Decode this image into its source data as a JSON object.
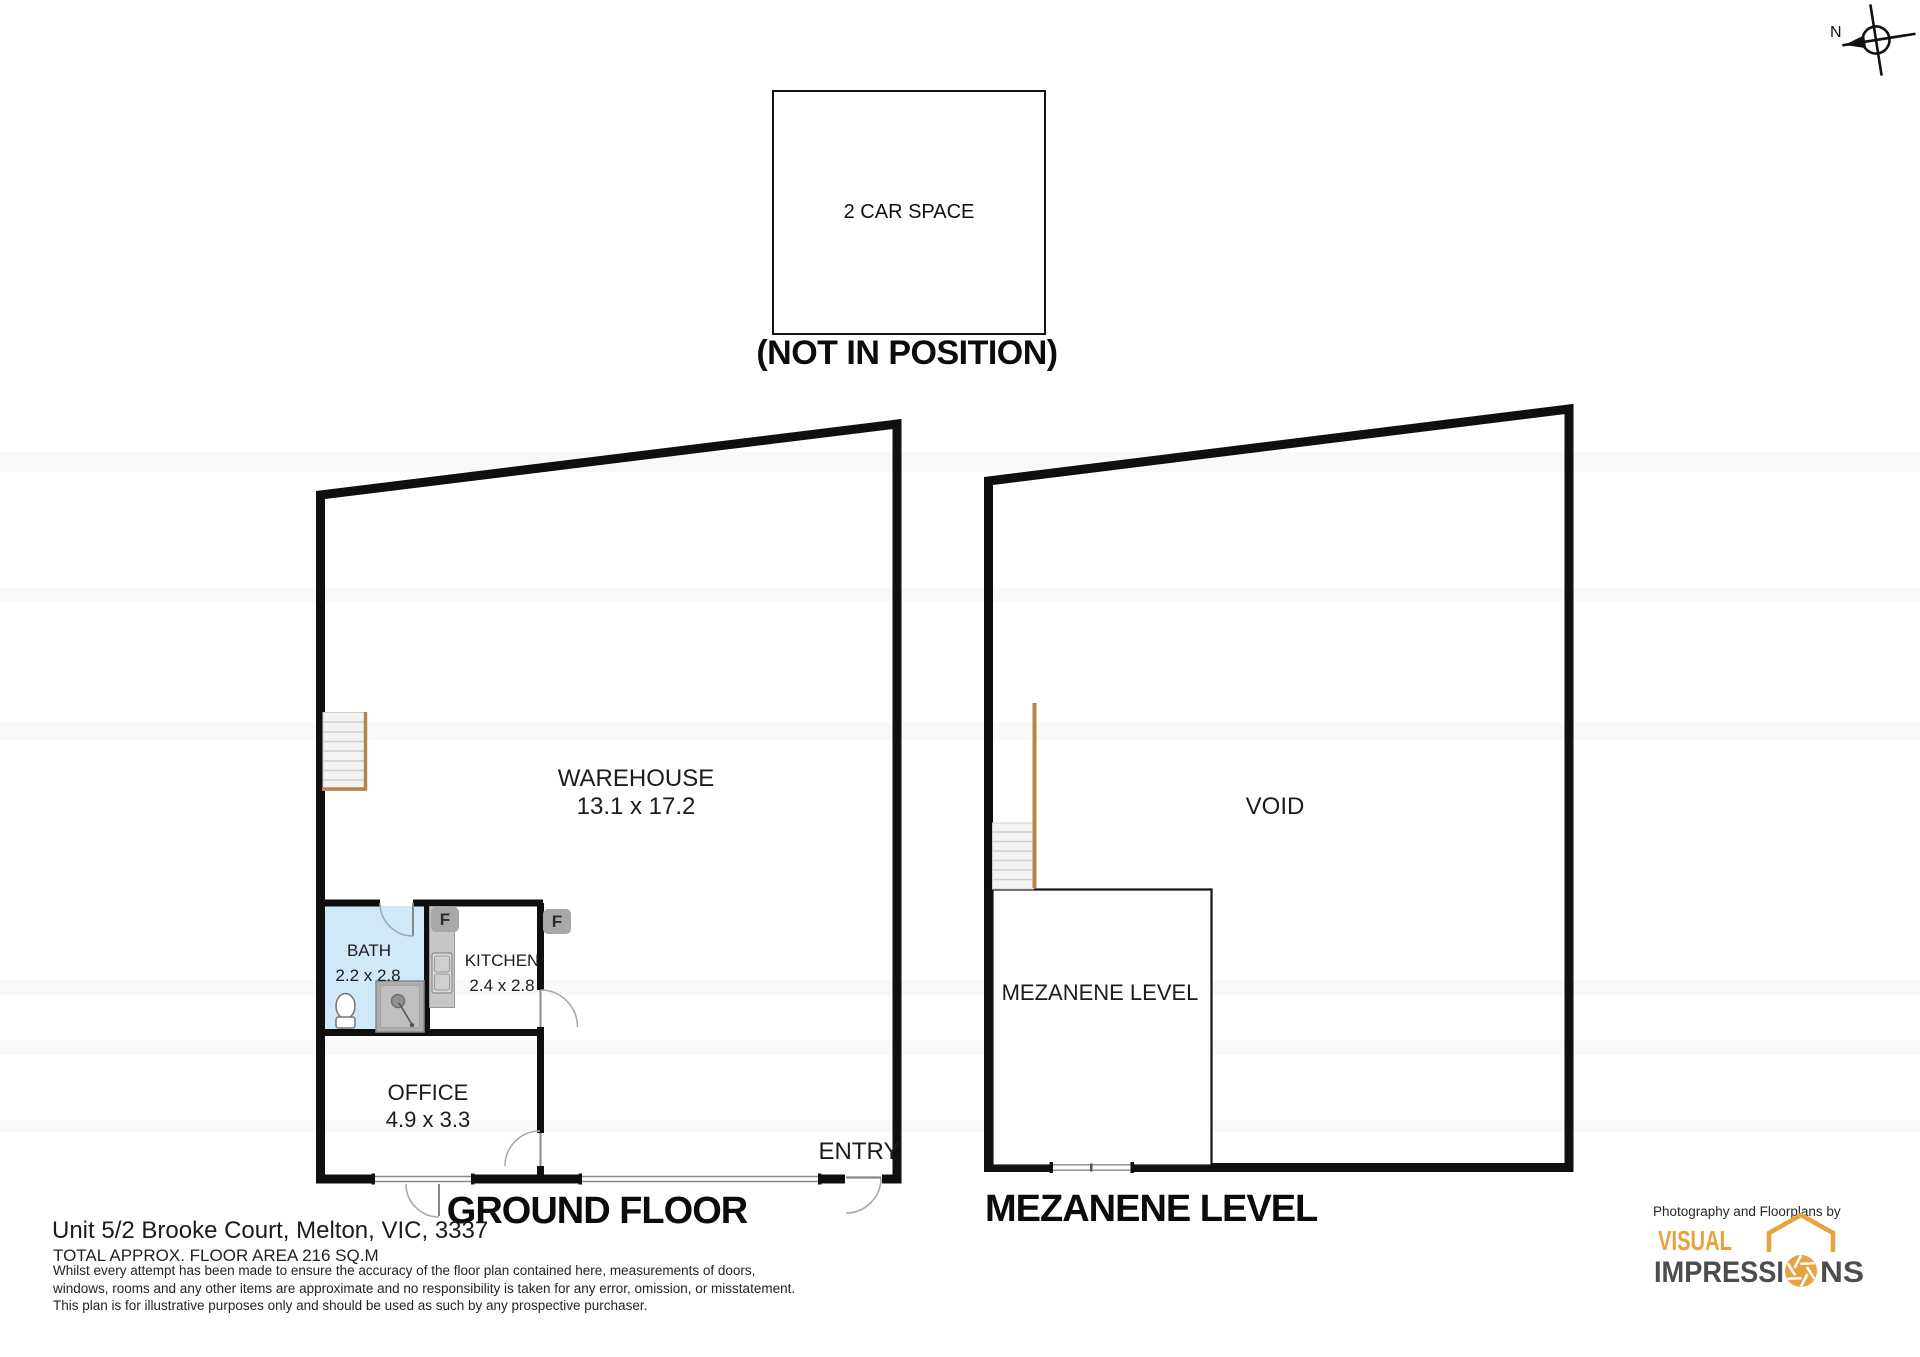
{
  "compass": {
    "north_label": "N"
  },
  "car_space": {
    "label": "2 CAR SPACE",
    "position_note": "(NOT IN POSITION)"
  },
  "ground_floor": {
    "title": "GROUND FLOOR",
    "warehouse_name": "WAREHOUSE",
    "warehouse_dims": "13.1 x 17.2",
    "bath_name": "BATH",
    "bath_dims": "2.2 x 2.8",
    "kitchen_name": "KITCHEN",
    "kitchen_dims": "2.4 x 2.8",
    "office_name": "OFFICE",
    "office_dims": "4.9 x 3.3",
    "entry_label": "ENTRY",
    "fixture_f1": "F",
    "fixture_f2": "F"
  },
  "mezzanine": {
    "title": "MEZANENE LEVEL",
    "void_label": "VOID",
    "room_label": "MEZANENE LEVEL"
  },
  "footer": {
    "address": "Unit 5/2 Brooke Court, Melton, VIC, 3337",
    "area_line": "TOTAL APPROX. FLOOR AREA 216 SQ.M",
    "disclaimer": [
      "Whilst every attempt has been made to ensure the accuracy of the floor plan contained here, measurements of doors,",
      "windows, rooms and any other items are approximate and no responsibility is taken for any error, omission, or misstatement.",
      "This plan is for illustrative purposes only and should be used as such by any prospective purchaser."
    ]
  },
  "branding": {
    "tagline": "Photography and Floorplans by",
    "name_top": "VISUAL",
    "name_bottom_left": "IMPRESSI",
    "name_bottom_right": "NS"
  },
  "colors": {
    "wall": "#0f0f0f",
    "bath_fill": "#cfe9f9",
    "stair_accent": "#b5854a",
    "window_line": "#8a8a8a",
    "door_arc": "#aaaaaa",
    "brand_orange": "#e8a33d",
    "brand_gray": "#4d4d4f"
  }
}
